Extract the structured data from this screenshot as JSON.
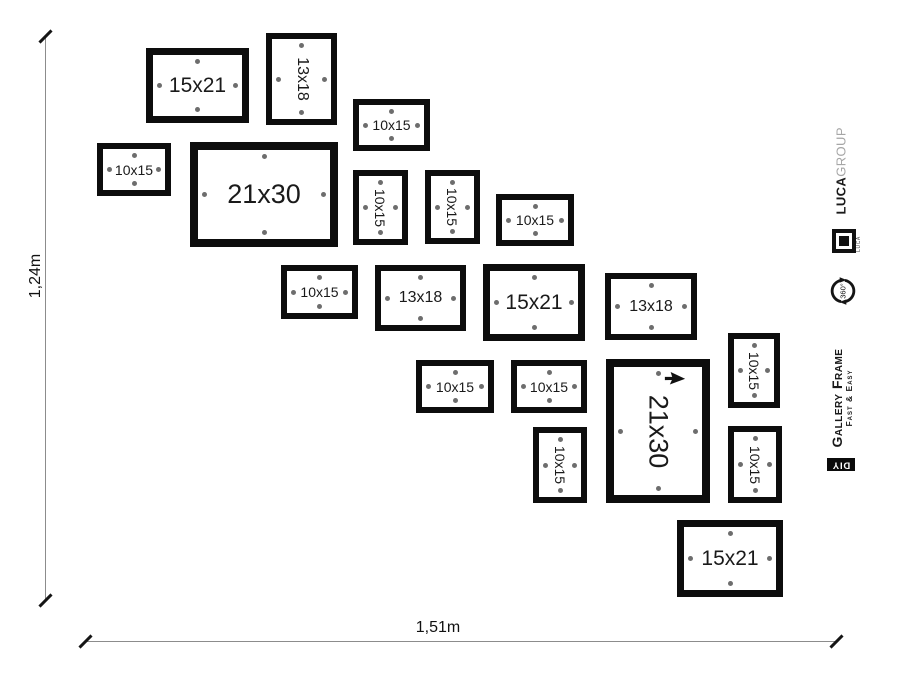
{
  "dimensions": {
    "height_label": "1,24m",
    "width_label": "1,51m"
  },
  "frames": [
    {
      "label": "15x21",
      "x": 146,
      "y": 48,
      "w": 103,
      "h": 75,
      "vertical": false
    },
    {
      "label": "13x18",
      "x": 266,
      "y": 33,
      "w": 71,
      "h": 92,
      "vertical": true
    },
    {
      "label": "10x15",
      "x": 353,
      "y": 99,
      "w": 77,
      "h": 52,
      "vertical": false
    },
    {
      "label": "10x15",
      "x": 97,
      "y": 143,
      "w": 74,
      "h": 53,
      "vertical": false
    },
    {
      "label": "21x30",
      "x": 190,
      "y": 142,
      "w": 148,
      "h": 105,
      "vertical": false
    },
    {
      "label": "10x15",
      "x": 353,
      "y": 170,
      "w": 55,
      "h": 75,
      "vertical": true
    },
    {
      "label": "10x15",
      "x": 425,
      "y": 170,
      "w": 55,
      "h": 74,
      "vertical": true
    },
    {
      "label": "10x15",
      "x": 496,
      "y": 194,
      "w": 78,
      "h": 52,
      "vertical": false
    },
    {
      "label": "10x15",
      "x": 281,
      "y": 265,
      "w": 77,
      "h": 54,
      "vertical": false
    },
    {
      "label": "13x18",
      "x": 375,
      "y": 265,
      "w": 91,
      "h": 66,
      "vertical": false
    },
    {
      "label": "15x21",
      "x": 483,
      "y": 264,
      "w": 102,
      "h": 77,
      "vertical": false
    },
    {
      "label": "13x18",
      "x": 605,
      "y": 273,
      "w": 92,
      "h": 67,
      "vertical": false
    },
    {
      "label": "10x15",
      "x": 416,
      "y": 360,
      "w": 78,
      "h": 53,
      "vertical": false
    },
    {
      "label": "10x15",
      "x": 511,
      "y": 360,
      "w": 76,
      "h": 53,
      "vertical": false
    },
    {
      "label": "21x30",
      "x": 606,
      "y": 359,
      "w": 104,
      "h": 144,
      "vertical": true,
      "cursor": true
    },
    {
      "label": "10x15",
      "x": 728,
      "y": 333,
      "w": 52,
      "h": 75,
      "vertical": true
    },
    {
      "label": "10x15",
      "x": 533,
      "y": 427,
      "w": 54,
      "h": 76,
      "vertical": true
    },
    {
      "label": "10x15",
      "x": 728,
      "y": 426,
      "w": 54,
      "h": 77,
      "vertical": true
    },
    {
      "label": "15x21",
      "x": 677,
      "y": 520,
      "w": 106,
      "h": 77,
      "vertical": false
    }
  ],
  "branding": {
    "brand_bold": "LUCA",
    "brand_light": "GROUP",
    "logo_text": "LUCA",
    "rotate_badge": "360°",
    "product_line1": "Gallery Frame",
    "product_line2": "Fast & Easy",
    "diy": "DIY"
  },
  "icons": {
    "cursor": "cursor-pointer-icon",
    "rotate": "rotate-360-icon",
    "logo": "luca-frame-logo-icon"
  },
  "colors": {
    "frame_border": "#0d0d0d",
    "mount_dot": "#6d6d6d",
    "dimension_line": "#8c8c8c",
    "text": "#1a1a1a",
    "brand_gray": "#a6a6a6"
  }
}
